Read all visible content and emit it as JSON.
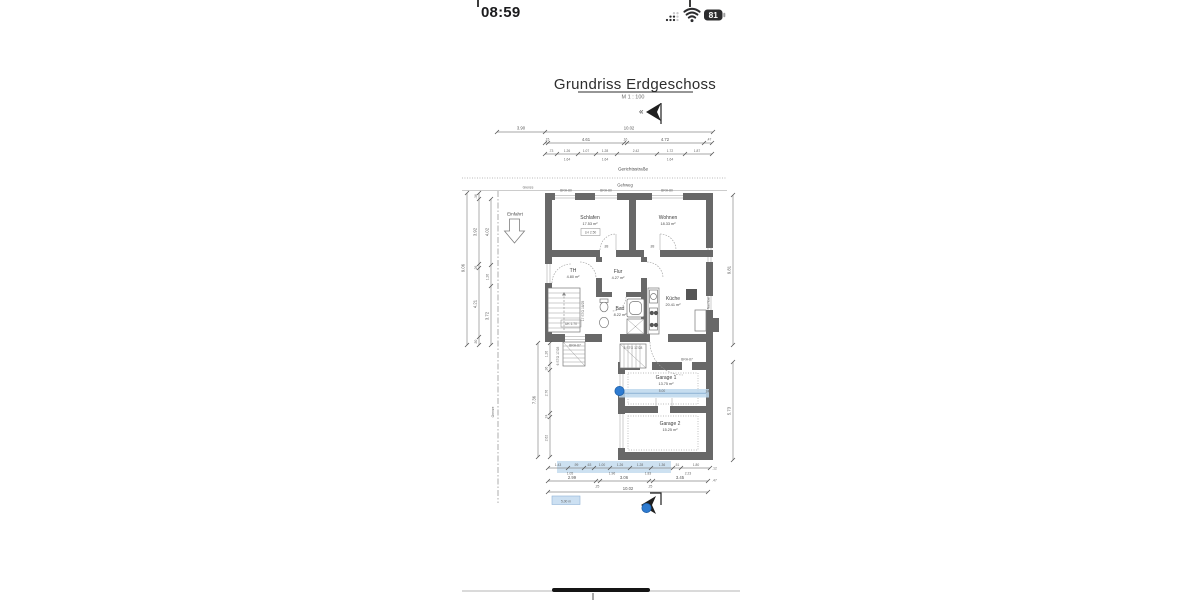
{
  "status_bar": {
    "time": "08:59",
    "battery_percent": "81"
  },
  "page": {
    "title": "Grundriss Erdgeschoss",
    "scale": "M 1 : 100",
    "street": "Gerichtsstraße",
    "sidewalk": "Gehweg",
    "boundary_top": "Grenze",
    "boundary_left": "Grenze",
    "driveway": "Einfahrt",
    "neighbor1": "Nachbar",
    "neighbor2": "Nachbar",
    "rooms": {
      "schlafen": {
        "name": "Schlafen",
        "area": "17.53 m²",
        "note": "LH 2.50"
      },
      "wohnen": {
        "name": "Wohnen",
        "area": "18.33 m²"
      },
      "th": {
        "name": "TH",
        "area": "4.80 m²"
      },
      "flur": {
        "name": "Flur",
        "area": "4.27 m²"
      },
      "bad": {
        "name": "Bad",
        "area": "8.22 m²"
      },
      "kueche": {
        "name": "Küche",
        "area": "20.41 m²"
      },
      "garage1": {
        "name": "Garage 1",
        "area": "13.75 m²"
      },
      "garage2": {
        "name": "Garage 2",
        "area": "15.25 m²"
      }
    },
    "notes": {
      "uk": "UK 1.70"
    },
    "stairs": {
      "main": "17 STG 18/25",
      "entry": "6 STG 17/28",
      "mid": "8 STG 17/28"
    },
    "windows": {
      "brh80": "BRH-80",
      "brh87": "BRH-87"
    },
    "doors": {
      "d1": ".88",
      "d2": ".88",
      "d3": ".76"
    },
    "dims": {
      "top1": [
        "3.90",
        "10.02"
      ],
      "top2": [
        ".15",
        "4.61",
        ".16",
        "4.72",
        ".47"
      ],
      "top3": [
        ".73",
        "1.26",
        "1.07",
        "1.28",
        "2.42",
        "1.72",
        "1.87"
      ],
      "top3_sub": [
        "1.64",
        "1.64",
        "1.64"
      ],
      "left_total": "9.06",
      "left_a": [
        ".36",
        "3.92",
        ".26",
        "4.21",
        ".50"
      ],
      "left_b": [
        "4.02",
        "1.26",
        "3.72"
      ],
      "lower_left_total": "7.36",
      "lower_left": [
        "1.26",
        ".36",
        "2.76",
        ".24",
        "2.62"
      ],
      "right_upper": "9.81",
      "right_lower": "5.73",
      "bottom1": [
        "1.43",
        ".99",
        ".63",
        "1.00",
        "1.26",
        "1.28",
        "1.36",
        ".51",
        "1.80"
      ],
      "bottom1_sub": [
        "1.05",
        "1.96",
        "1.83",
        "2.23"
      ],
      "bottom2": [
        "2.99",
        ".25",
        "3.06",
        ".25",
        "3.45"
      ],
      "bottom3": "10.02",
      "edge1": ".12",
      "edge2": ".47"
    },
    "measurement": {
      "value": "5.00",
      "wall_tick": "24",
      "label": "5,00 m"
    }
  }
}
